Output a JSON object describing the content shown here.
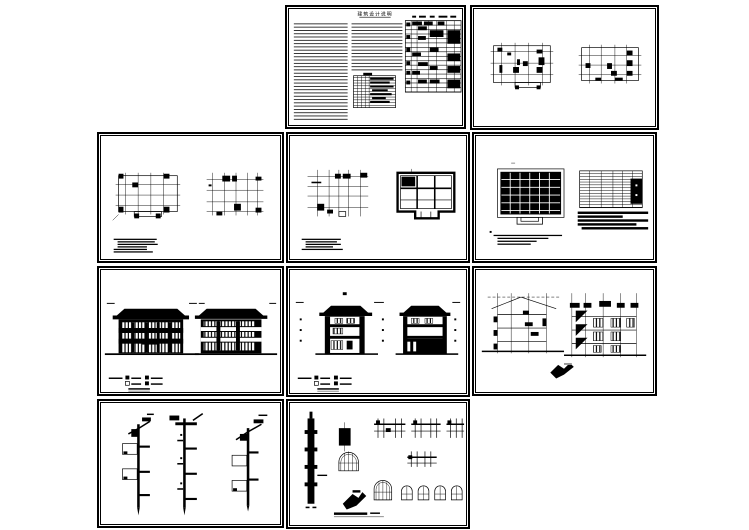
{
  "canvas": {
    "paper": "#ffffff",
    "ink": "#000000"
  },
  "sheets": [
    {
      "title": "建筑设计说明"
    }
  ]
}
